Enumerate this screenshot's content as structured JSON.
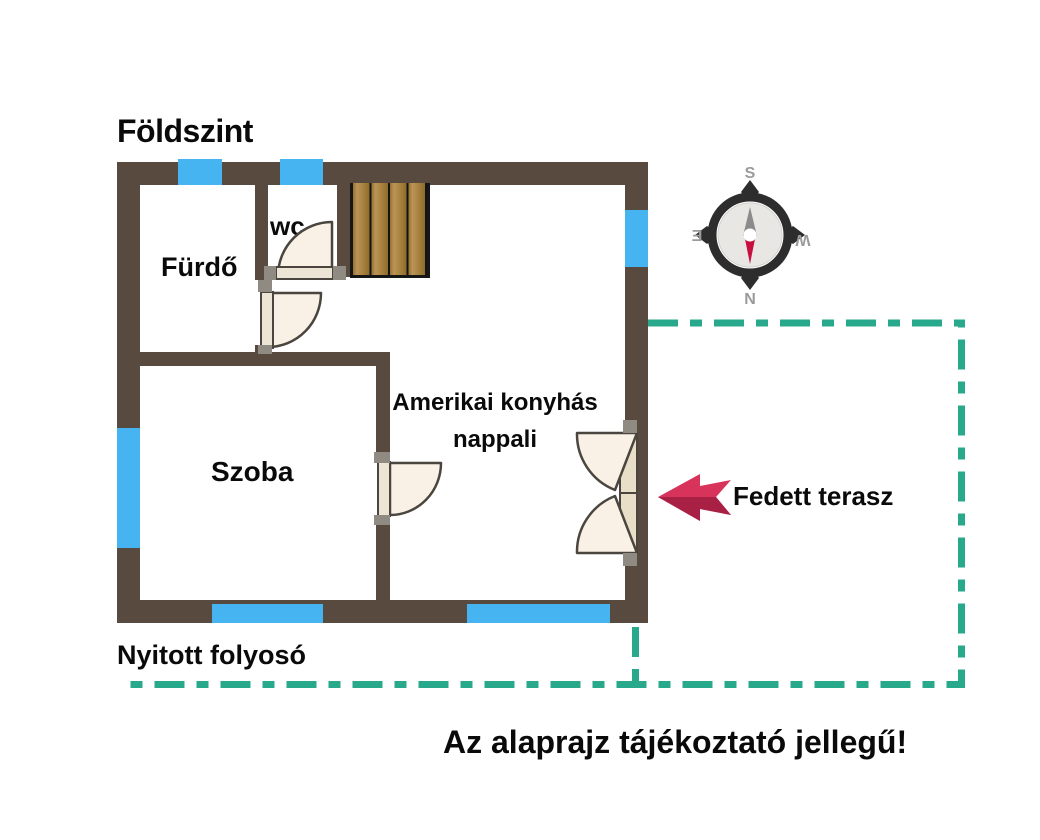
{
  "title": "Földszint",
  "rooms": {
    "bathroom": "Fürdő",
    "wc": "wc",
    "bedroom": "Szoba",
    "living_line1": "Amerikai konyhás",
    "living_line2": "nappali"
  },
  "annotations": {
    "terrace": "Fedett terasz",
    "corridor": "Nyitott folyosó",
    "disclaimer": "Az alaprajz tájékoztató jellegű!"
  },
  "compass": {
    "top": "S",
    "bottom": "N",
    "left": "E",
    "right": "W"
  },
  "colors": {
    "wall": "#584a3e",
    "window": "#45b4f0",
    "terrace_dash": "#28a98b",
    "door_fill": "#faf1e6",
    "door_stroke": "#4a463f",
    "arrow_red": "#d8335a",
    "arrow_red_dark": "#a92045",
    "needle_red": "#c8103e",
    "needle_gray": "#8b8b8b",
    "compass_ring": "#2d2d2d",
    "compass_letter": "#9a9a9a",
    "text": "#0a0a0a"
  }
}
